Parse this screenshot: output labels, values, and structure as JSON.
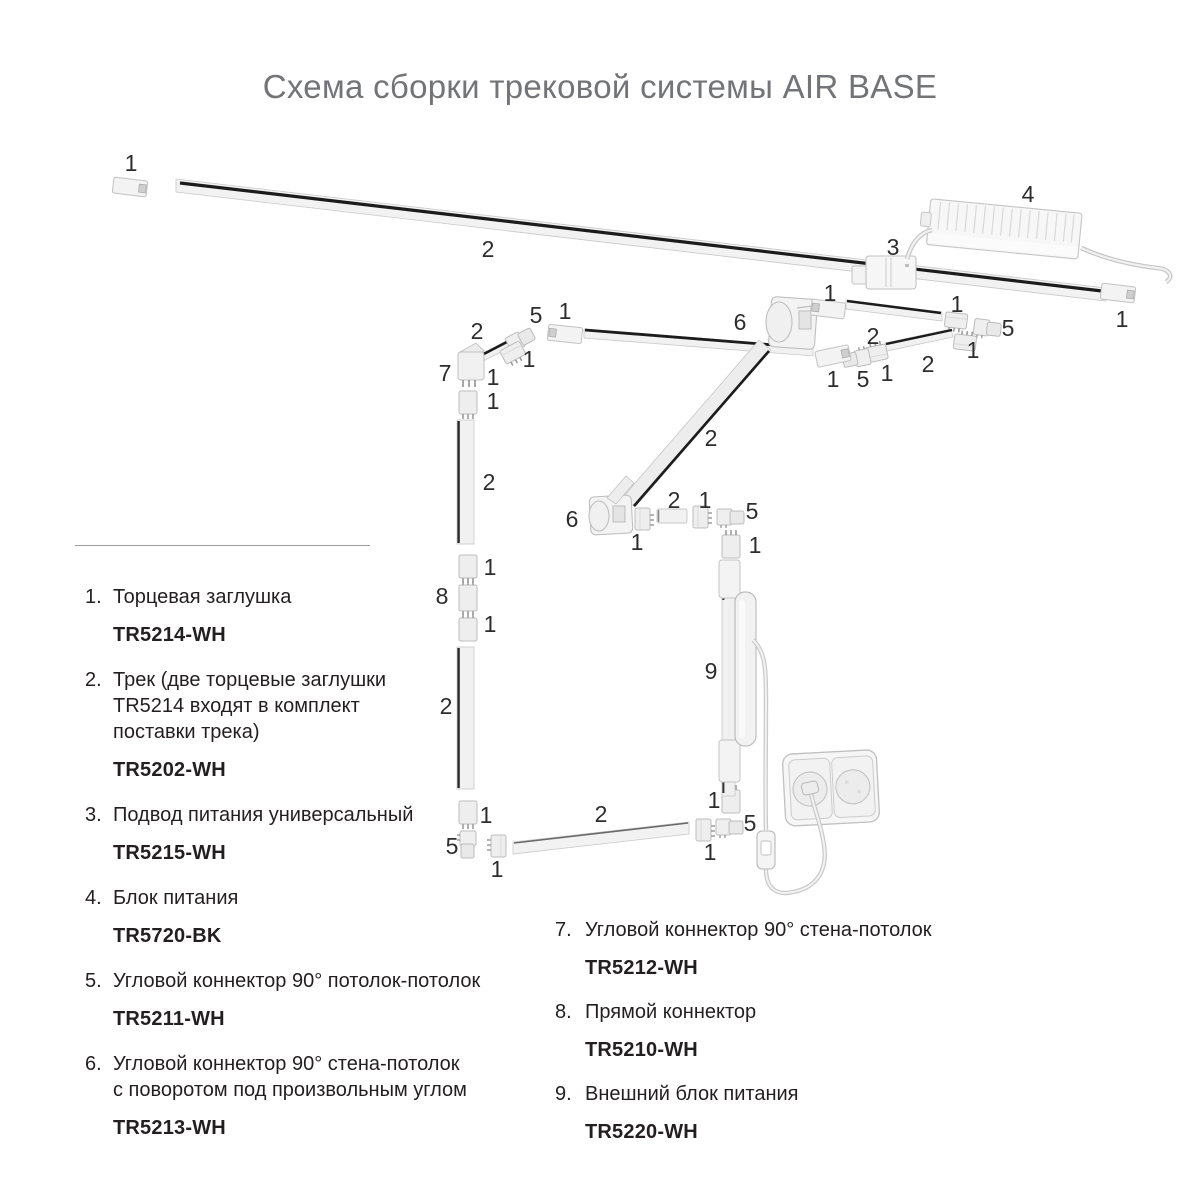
{
  "title": "Схема сборки трековой системы AIR BASE",
  "legend": {
    "left": [
      {
        "num": "1.",
        "text": "Торцевая заглушка",
        "code": "TR5214-WH"
      },
      {
        "num": "2.",
        "text": "Трек (две торцевые заглушки\nTR5214 входят в комплект\nпоставки трека)",
        "code": "TR5202-WH"
      },
      {
        "num": "3.",
        "text": "Подвод питания универсальный",
        "code": "TR5215-WH"
      },
      {
        "num": "4.",
        "text": "Блок питания",
        "code": "TR5720-BK"
      },
      {
        "num": "5.",
        "text": "Угловой коннектор 90° потолок-потолок",
        "code": "TR5211-WH"
      },
      {
        "num": "6.",
        "text": "Угловой коннектор 90° стена-потолок\nс поворотом под произвольным углом",
        "code": "TR5213-WH"
      }
    ],
    "right": [
      {
        "num": "7.",
        "text": "Угловой коннектор 90° стена-потолок",
        "code": "TR5212-WH"
      },
      {
        "num": "8.",
        "text": "Прямой коннектор",
        "code": "TR5210-WH"
      },
      {
        "num": "9.",
        "text": "Внешний блок питания",
        "code": "TR5220-WH"
      }
    ]
  },
  "diagram": {
    "colors": {
      "track_stripe": "#1c1c1c",
      "part_fill": "#f1f1f1",
      "part_stroke": "#c2c2c2",
      "callout_text": "#2d2d2d",
      "title_gray": "#737477"
    },
    "callouts": [
      {
        "n": "1",
        "x": 131,
        "y": 165
      },
      {
        "n": "2",
        "x": 488,
        "y": 251
      },
      {
        "n": "3",
        "x": 893,
        "y": 249
      },
      {
        "n": "4",
        "x": 1028,
        "y": 196
      },
      {
        "n": "1",
        "x": 1122,
        "y": 321
      },
      {
        "n": "6",
        "x": 740,
        "y": 324
      },
      {
        "n": "1",
        "x": 830,
        "y": 295
      },
      {
        "n": "2",
        "x": 873,
        "y": 338
      },
      {
        "n": "1",
        "x": 957,
        "y": 306
      },
      {
        "n": "5",
        "x": 1008,
        "y": 330
      },
      {
        "n": "1",
        "x": 973,
        "y": 352
      },
      {
        "n": "2",
        "x": 928,
        "y": 366
      },
      {
        "n": "1",
        "x": 833,
        "y": 381
      },
      {
        "n": "5",
        "x": 863,
        "y": 381
      },
      {
        "n": "1",
        "x": 887,
        "y": 375
      },
      {
        "n": "1",
        "x": 565,
        "y": 313
      },
      {
        "n": "5",
        "x": 536,
        "y": 317
      },
      {
        "n": "2",
        "x": 477,
        "y": 333
      },
      {
        "n": "1",
        "x": 529,
        "y": 361
      },
      {
        "n": "7",
        "x": 445,
        "y": 375
      },
      {
        "n": "1",
        "x": 493,
        "y": 379
      },
      {
        "n": "1",
        "x": 493,
        "y": 403
      },
      {
        "n": "2",
        "x": 489,
        "y": 484
      },
      {
        "n": "1",
        "x": 490,
        "y": 569
      },
      {
        "n": "8",
        "x": 442,
        "y": 598
      },
      {
        "n": "1",
        "x": 490,
        "y": 626
      },
      {
        "n": "2",
        "x": 446,
        "y": 708
      },
      {
        "n": "1",
        "x": 486,
        "y": 817
      },
      {
        "n": "5",
        "x": 452,
        "y": 848
      },
      {
        "n": "1",
        "x": 497,
        "y": 871
      },
      {
        "n": "2",
        "x": 601,
        "y": 816
      },
      {
        "n": "1",
        "x": 710,
        "y": 854
      },
      {
        "n": "1",
        "x": 714,
        "y": 802
      },
      {
        "n": "5",
        "x": 750,
        "y": 825
      },
      {
        "n": "2",
        "x": 711,
        "y": 440
      },
      {
        "n": "6",
        "x": 572,
        "y": 521
      },
      {
        "n": "1",
        "x": 637,
        "y": 544
      },
      {
        "n": "2",
        "x": 674,
        "y": 502
      },
      {
        "n": "1",
        "x": 705,
        "y": 502
      },
      {
        "n": "5",
        "x": 752,
        "y": 513
      },
      {
        "n": "1",
        "x": 755,
        "y": 547
      },
      {
        "n": "9",
        "x": 711,
        "y": 673
      }
    ]
  }
}
